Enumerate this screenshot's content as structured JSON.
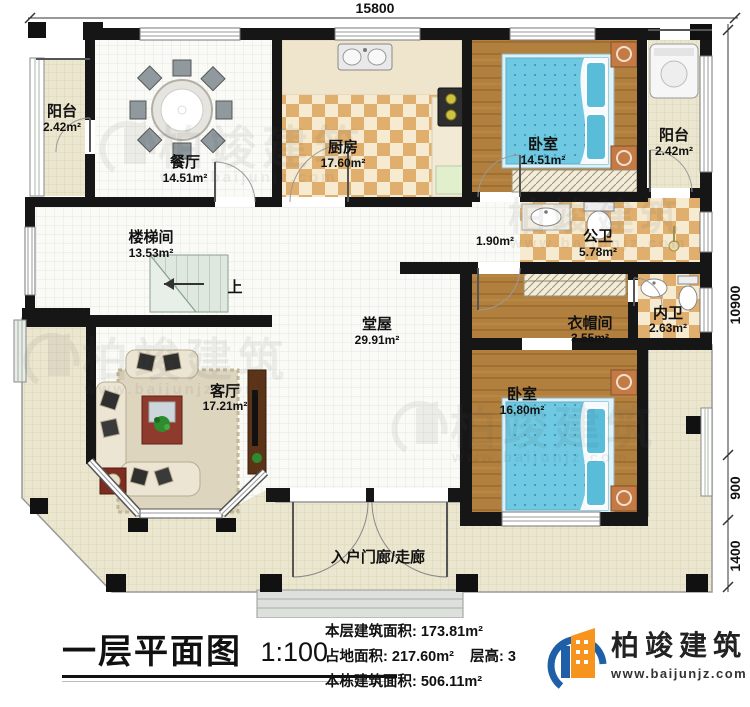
{
  "plan": {
    "dimensions": {
      "top": "15800",
      "right_upper": "10900",
      "right_middle": "900",
      "right_lower": "1400"
    },
    "rooms": {
      "balcony_left": {
        "name": "阳台",
        "area": "2.42m²"
      },
      "dining": {
        "name": "餐厅",
        "area": "14.51m²"
      },
      "kitchen": {
        "name": "厨房",
        "area": "17.60m²"
      },
      "bedroom_top": {
        "name": "卧室",
        "area": "14.51m²"
      },
      "balcony_right": {
        "name": "阳台",
        "area": "2.42m²"
      },
      "stairwell": {
        "name": "楼梯间",
        "area": "13.53m²"
      },
      "corridor": {
        "area": "1.90m²"
      },
      "public_bath": {
        "name": "公卫",
        "area": "5.78m²"
      },
      "hall": {
        "name": "堂屋",
        "area": "29.91m²"
      },
      "cloakroom": {
        "name": "衣帽间",
        "area": "3.55m²"
      },
      "private_bath": {
        "name": "内卫",
        "area": "2.63m²"
      },
      "living": {
        "name": "客厅",
        "area": "17.21m²"
      },
      "bedroom_bottom": {
        "name": "卧室",
        "area": "16.80m²"
      },
      "porch": {
        "name": "入户门廊/走廊"
      }
    },
    "stair_up": "上"
  },
  "title_block": {
    "title": "一层平面图",
    "scale": "1:100",
    "floor_area_label": "本层建筑面积:",
    "floor_area_value": "173.81m²",
    "land_area_label": "占地面积:",
    "land_area_value": "217.60m²",
    "height_label": "层高:",
    "height_value": "3",
    "total_area_label": "本栋建筑面积:",
    "total_area_value": "506.11m²"
  },
  "brand": {
    "name": "柏竣建筑",
    "website": "www.baijunjz.com"
  },
  "watermark": {
    "name": "柏竣建筑",
    "website": "www.baijunjz.com"
  },
  "colors": {
    "wall": "#161616",
    "porch_floor": "#ebe6cf",
    "wood_floor": "#b2803e",
    "checker_dark": "#e0af6d",
    "checker_light": "#f6ead0",
    "bed_blue": "#6fc9e2",
    "brand_blue": "#1e5fa8",
    "brand_orange": "#f7941e"
  }
}
